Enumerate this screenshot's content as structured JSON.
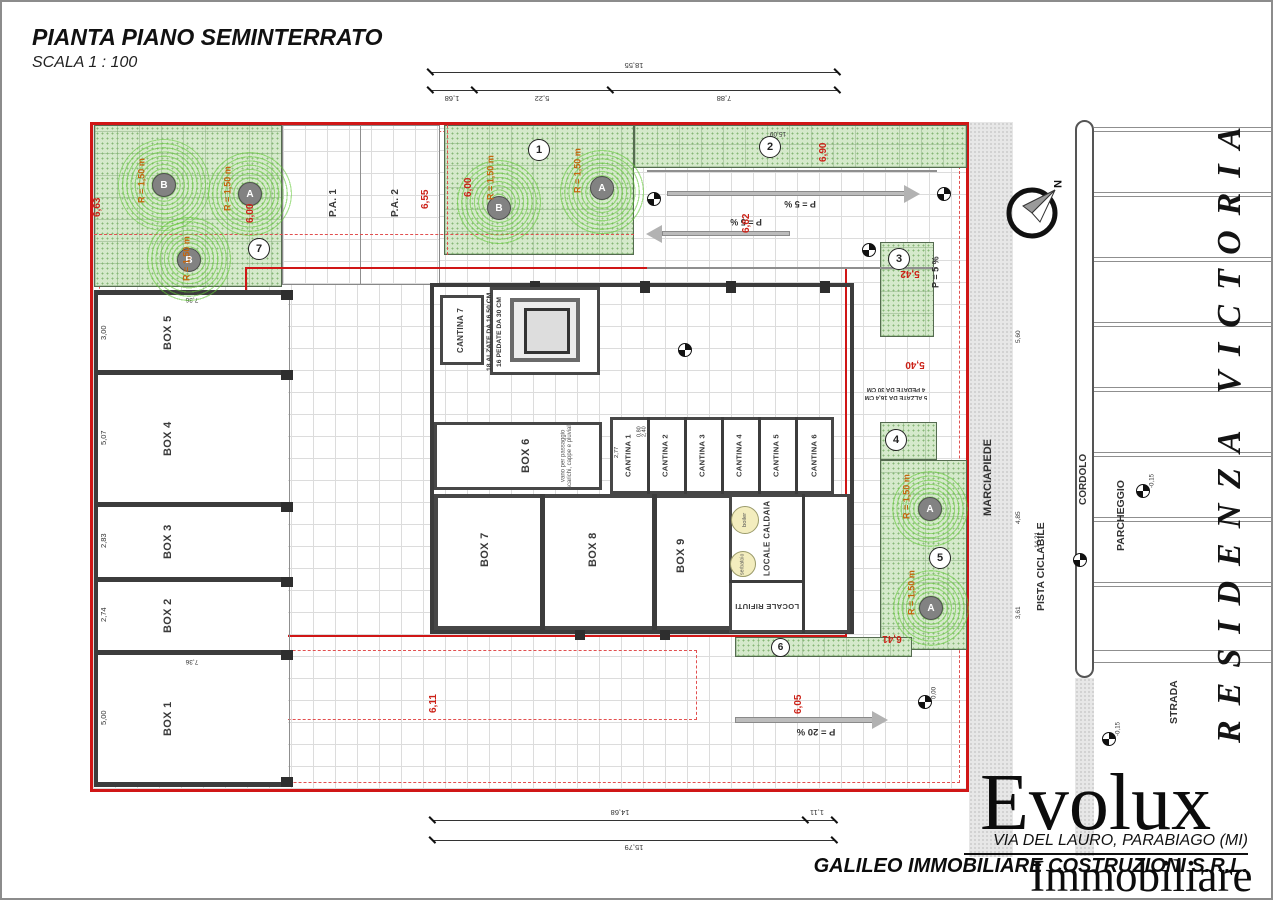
{
  "title": {
    "main": "PIANTA PIANO SEMINTERRATO",
    "scale": "SCALA 1 : 100"
  },
  "side_text": "RESIDENZA VICTORIA",
  "compass": {
    "north_label": "N"
  },
  "footer": {
    "brand": "Evolux",
    "brand_sub": "Immobiliare",
    "address": "VIA DEL LAURO, PARABIAGO (MI)",
    "company": "GALILEO IMMOBILIARE COSTRUZIONI S.R.L."
  },
  "streets": {
    "marciapiede": "MARCIAPIEDE",
    "pista_ciclabile": "PISTA CICLABILE",
    "cordolo": "CORDOLO",
    "parcheggio": "PARCHEGGIO",
    "strada": "STRADA"
  },
  "parking_bays": {
    "pa1": "P.A. 1",
    "pa2": "P.A. 2"
  },
  "rooms": {
    "boxes": [
      "BOX 1",
      "BOX 2",
      "BOX 3",
      "BOX 4",
      "BOX 5",
      "BOX 6",
      "BOX 7",
      "BOX 8",
      "BOX 9"
    ],
    "cantine": [
      "CANTINA 1",
      "CANTINA 2",
      "CANTINA 3",
      "CANTINA 4",
      "CANTINA 5",
      "CANTINA 6",
      "CANTINA 7"
    ],
    "locale_caldaia": "LOCALE CALDAIA",
    "locale_rifiuti": "LOCALE RIFIUTI",
    "boiler": "boiler",
    "serbatoio": "serbatoio",
    "box6_note": "vano per passaggio scarichi, cappe e pluviali"
  },
  "stairs": {
    "main_risers": "18 ALZATE DA 16,50 CM",
    "main_treads": "16 PEDATE DA 30 CM",
    "ext_risers": "5 ALZATE DA 16,4 CM",
    "ext_treads": "4 PEDATE DA 30 CM"
  },
  "ramps": {
    "slope_5": "P = 5 %",
    "slope_20": "P = 20 %"
  },
  "trees": {
    "radius_label": "R = 1,50 m",
    "type_a": "A",
    "type_b": "B"
  },
  "zones": [
    "1",
    "2",
    "3",
    "4",
    "5",
    "6",
    "7"
  ],
  "levels": {
    "zero": "0,00",
    "minus_015": "-0,15"
  },
  "dims_red": {
    "d1": "6,63",
    "d2": "6,00",
    "d3": "6,55",
    "d4": "6,90",
    "d5": "6,62",
    "d6": "5,42",
    "d7": "5,40",
    "d8": "6,11",
    "d9": "6,05",
    "d10": "6,41"
  },
  "dims": {
    "top_total": "18,55",
    "top_a": "1,68",
    "top_b": "5,22",
    "top_c": "7,88",
    "bottom_a": "14,68",
    "bottom_b": "1,11",
    "bottom_total": "15,79",
    "box5_h": "3,00",
    "box4_h": "5,07",
    "box3_h": "2,83",
    "box2_h": "2,74",
    "box1_h": "5,00",
    "box_w": "7,36",
    "cantina_w": "2,77",
    "door_w": "0,80",
    "door_h": "2,40",
    "walk_a": "5,60",
    "walk_b": "3,61",
    "walk_c": "14,21",
    "bike_w": "4,85",
    "strip_w": "15,09"
  }
}
